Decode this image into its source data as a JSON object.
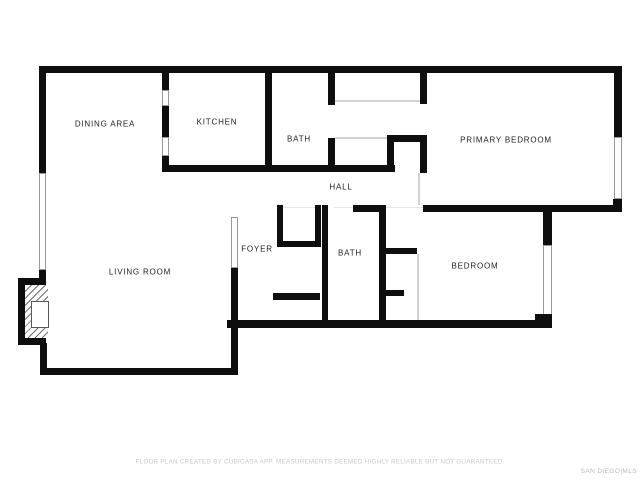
{
  "floor_plan": {
    "rooms": [
      {
        "id": "dining-area",
        "label": "DINING AREA"
      },
      {
        "id": "kitchen",
        "label": "KITCHEN"
      },
      {
        "id": "bath-upper",
        "label": "BATH"
      },
      {
        "id": "primary-bedroom",
        "label": "PRIMARY BEDROOM"
      },
      {
        "id": "hall",
        "label": "HALL"
      },
      {
        "id": "foyer",
        "label": "FOYER"
      },
      {
        "id": "bath-lower",
        "label": "BATH"
      },
      {
        "id": "living-room",
        "label": "LIVING ROOM"
      },
      {
        "id": "bedroom",
        "label": "BEDROOM"
      }
    ],
    "footer_disclaimer": "FLOOR PLAN CREATED BY CUBICASA APP. MEASUREMENTS DEEMED HIGHLY RELIABLE BUT NOT GUARANTEED.",
    "watermark": "SAN DIEGO|MLS",
    "colors": {
      "wall": "#0e0e0e",
      "background": "#ffffff",
      "label_text": "#1d1d1d",
      "opening_outline": "#999999",
      "closet_line": "#d2d2d2",
      "disclaimer_text": "#c8c8c8",
      "watermark_text": "#b8b8b8"
    }
  }
}
